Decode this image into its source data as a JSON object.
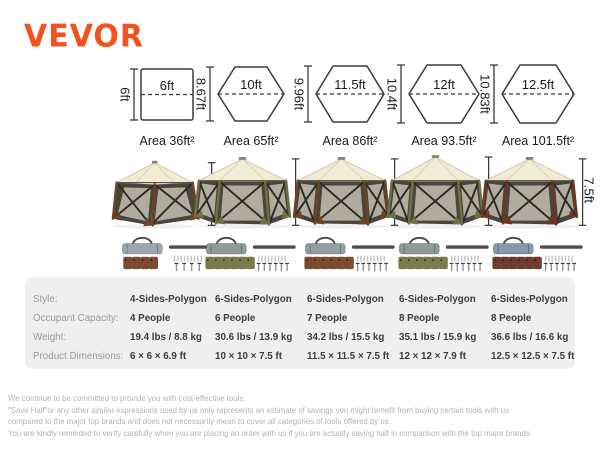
{
  "brand": {
    "name": "VEVOR",
    "color": "#F4511E"
  },
  "shapes_row": {
    "columns": [
      {
        "type": "square",
        "width_label": "6ft",
        "height_label": "6ft",
        "area_label": "Area 36ft²"
      },
      {
        "type": "hexagon",
        "width_label": "10ft",
        "height_label": "8.67ft",
        "area_label": "Area 65ft²"
      },
      {
        "type": "hexagon",
        "width_label": "11.5ft",
        "height_label": "9.96ft",
        "area_label": "Area 86ft²"
      },
      {
        "type": "hexagon",
        "width_label": "12ft",
        "height_label": "10.4ft",
        "area_label": "Area 93.5ft²"
      },
      {
        "type": "hexagon",
        "width_label": "12.5ft",
        "height_label": "10.83ft",
        "area_label": "Area 101.5ft²"
      }
    ]
  },
  "tents_row": {
    "columns": [
      {
        "height_label": "6.9ft",
        "frame_color": "#6e4326"
      },
      {
        "height_label": "7.5ft",
        "frame_color": "#6e7143"
      },
      {
        "height_label": "7.5ft",
        "frame_color": "#6e4326"
      },
      {
        "height_label": "7.9ft",
        "frame_color": "#6e7143"
      },
      {
        "height_label": "7.5ft",
        "frame_color": "#703425"
      }
    ]
  },
  "accessories_row": {
    "columns": [
      {
        "bag_color": "#9aa7b0",
        "pouch_color": "#7d4a31",
        "pouch_count": 4,
        "peg_count": 4
      },
      {
        "bag_color": "#8d9b94",
        "pouch_color": "#797d4e",
        "pouch_count": 6,
        "peg_count": 6
      },
      {
        "bag_color": "#92a0a4",
        "pouch_color": "#7d4a31",
        "pouch_count": 6,
        "peg_count": 6
      },
      {
        "bag_color": "#8d9b94",
        "pouch_color": "#797d4e",
        "pouch_count": 6,
        "peg_count": 6
      },
      {
        "bag_color": "#8599ab",
        "pouch_color": "#703c2d",
        "pouch_count": 6,
        "peg_count": 6
      }
    ]
  },
  "spec_table": {
    "rows": [
      {
        "label": "Style:",
        "values": [
          "4-Sides-Polygon",
          "6-Sides-Polygon",
          "6-Sides-Polygon",
          "6-Sides-Polygon",
          "6-Sides-Polygon"
        ]
      },
      {
        "label": "Occupant Capacity:",
        "values": [
          "4 People",
          "6 People",
          "7 People",
          "8 People",
          "8 People"
        ]
      },
      {
        "label": "Weight:",
        "values": [
          "19.4 lbs / 8.8 kg",
          "30.6 lbs / 13.9 kg",
          "34.2 lbs / 15.5 kg",
          "35.1 lbs / 15.9 kg",
          "36.6 lbs / 16.6 kg"
        ]
      },
      {
        "label": "Product Dimensions:",
        "values": [
          "6 × 6 × 6.9 ft",
          "10 × 10 × 7.5 ft",
          "11.5 × 11.5 × 7.5 ft",
          "12 × 12 × 7.9 ft",
          "12.5 × 12.5 × 7.5 ft"
        ]
      }
    ]
  },
  "footer": {
    "lines": [
      "We continue to be committed to provide you with cost-effective tools.",
      "\"Save Half\"or any other similar expressions used by us only represents an estimate of savings you might benefit from buying certain tools with us",
      "compared to the major top brands and does not necessarily mean to cover all categories of tools offered by us.",
      "You are kindly reminded to verify carefully when you are placing an order with us if you are actually saving half in comparison with the top major brands."
    ]
  }
}
